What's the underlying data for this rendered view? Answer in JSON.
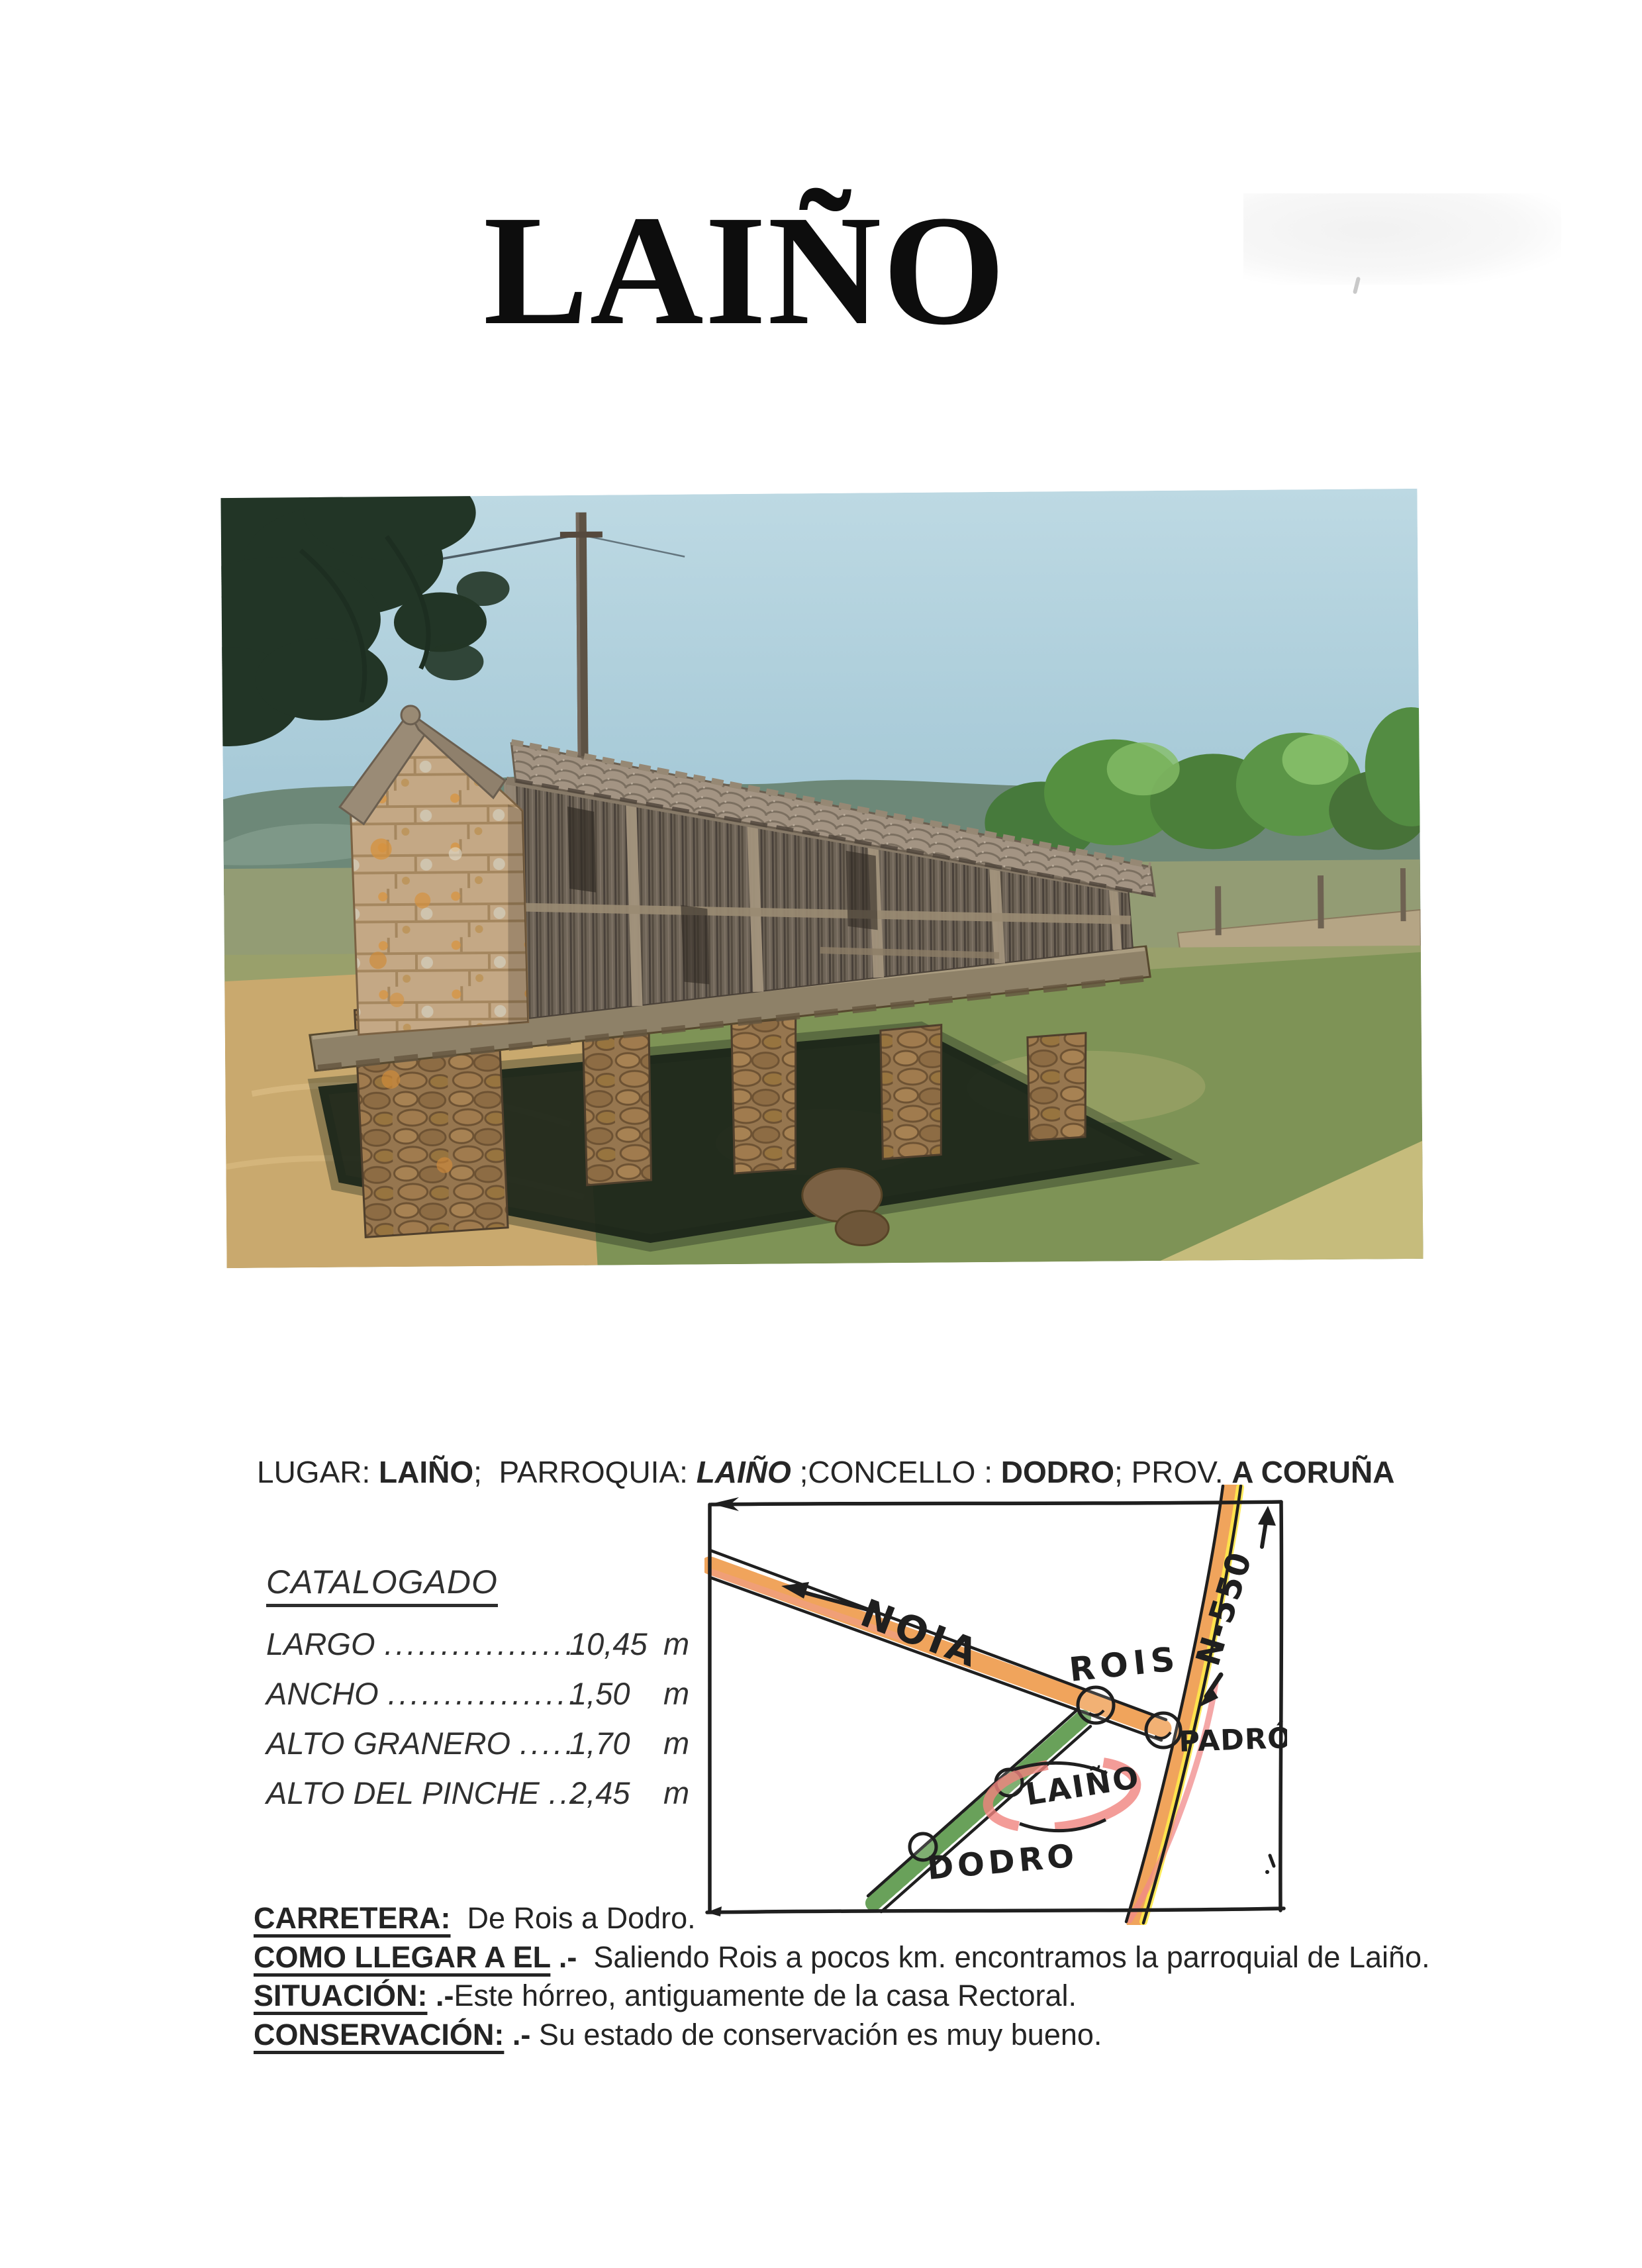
{
  "page": {
    "title": "LAIÑO"
  },
  "lugar_line": {
    "segments": [
      {
        "text": "LUGAR: "
      },
      {
        "text": "LAIÑO",
        "bold": true
      },
      {
        "text": ";  PARROQUIA: "
      },
      {
        "text": "LAIÑO",
        "bold": true,
        "italic": true
      },
      {
        "text": " ;CONCELLO : "
      },
      {
        "text": "DODRO",
        "bold": true
      },
      {
        "text": "; PROV. "
      },
      {
        "text": "A CORUÑA",
        "bold": true
      }
    ]
  },
  "catalog": {
    "heading": "CATALOGADO",
    "rows": [
      {
        "label": "LARGO",
        "dots": "..................",
        "value": "10,45",
        "unit": "m"
      },
      {
        "label": "ANCHO",
        "dots": ".................",
        "value": "1,50",
        "unit": "m"
      },
      {
        "label": "ALTO GRANERO",
        "dots": ".....",
        "value": "1,70",
        "unit": "m"
      },
      {
        "label": "ALTO DEL PINCHE",
        "dots": "...",
        "value": "2,45",
        "unit": "m"
      }
    ]
  },
  "map": {
    "labels": {
      "noia": "NOIA",
      "rois": "ROIS",
      "n550": "N-550",
      "padron": "PADRÓN",
      "laino": "LAIÑO",
      "dodro": "DODRO"
    },
    "colors": {
      "road_orange": "#f0a45c",
      "road_yellow": "#ffe94a",
      "road_green": "#7cb36b",
      "highlight_pink": "#f0837e",
      "ink": "#1f1f1f"
    }
  },
  "info": {
    "rows": [
      {
        "label": "CARRETERA:",
        "sep": "",
        "text": "  De Rois a Dodro."
      },
      {
        "label": "COMO LLEGAR A EL",
        "sep": " .-  ",
        "text": "Saliendo Rois a pocos km. encontramos la parroquial de Laiño."
      },
      {
        "label": "SITUACIÓN:",
        "sep": " .-",
        "text": "Este hórreo, antiguamente de la casa Rectoral."
      },
      {
        "label": "CONSERVACIÓN:",
        "sep": " .- ",
        "text": "Su estado de conservación es muy bueno."
      }
    ]
  }
}
